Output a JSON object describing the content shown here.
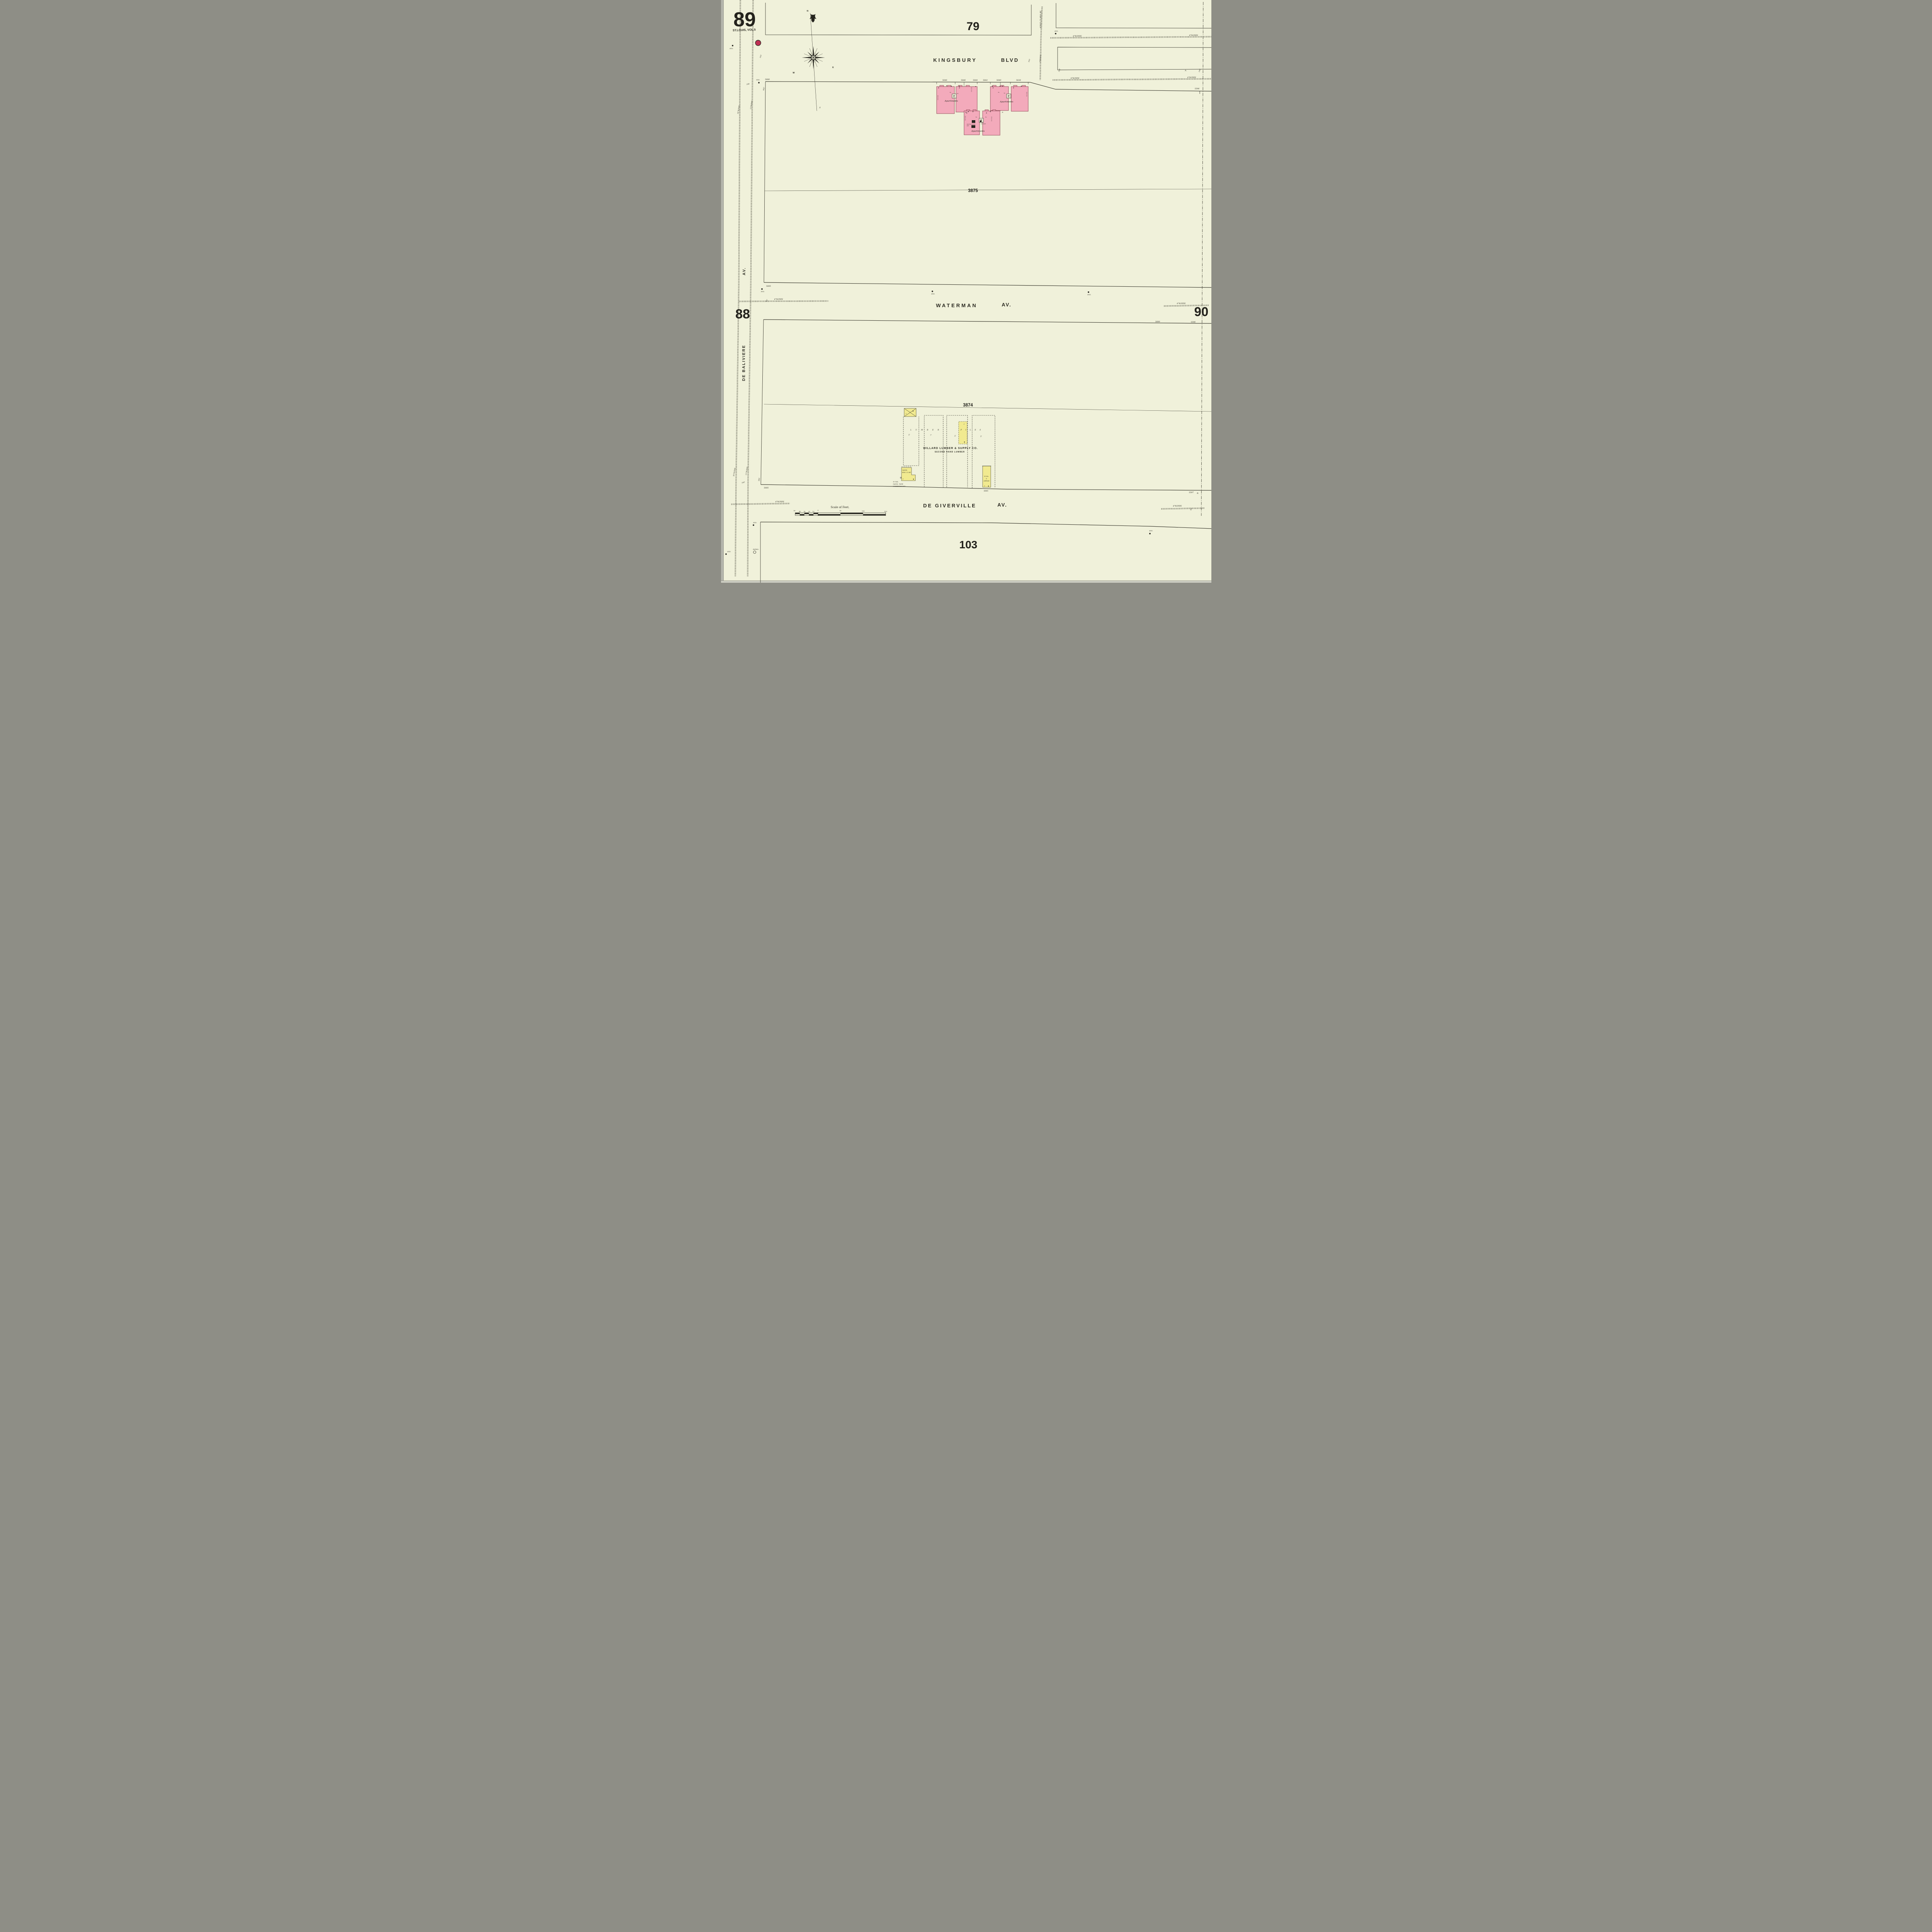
{
  "sheet": {
    "number": "89",
    "volume": "ST.LOUIS, VOL.5",
    "adjacent": {
      "top": "79",
      "left": "88",
      "right": "90",
      "bottom": "103"
    }
  },
  "compass": {
    "n": "N",
    "e": "E",
    "w": "W",
    "s": "S"
  },
  "streets": {
    "kingsbury": "KINGSBURY",
    "kingsbury_type": "BLVD",
    "waterman": "WATERMAN",
    "waterman_type": "AV.",
    "de_giverville": "DE GIVERVILLE",
    "de_giverville_type": "AV.",
    "de_baliviere": "DE BALIVIERE",
    "de_baliviere_type": "AV.",
    "clara_pipe": "6\"W.P. CLARA AV."
  },
  "blocks": {
    "north": "3875",
    "south": "3874"
  },
  "addresses": {
    "a5680": "5680",
    "a5648": "5648",
    "a5646": "5646",
    "a5644": "5644",
    "a5642": "5642",
    "a5640": "5640",
    "a5638": "5638",
    "a5596_ne": "5596",
    "a5685_waterman": "5685",
    "a5600": "5600",
    "a5596_waterman": "5596",
    "a5685_giverville": "5685",
    "a5641": "5641",
    "a5597": "5597",
    "letter_a": "A.",
    "letter_b": "B."
  },
  "apartments": {
    "label": "Apartments",
    "stories": "4",
    "elevator": "E",
    "ea": "Ea.",
    "b_mark": "B.",
    "heating1": "HEATING BLRS",
    "heating2": "BST-",
    "chimney": "CH.",
    "chimney_note": "10'ABV.RF.",
    "wall": [
      "16",
      "12",
      "12",
      "12"
    ]
  },
  "lumber": {
    "company": "WILLARD LUMBER & SUPPLY CO.",
    "company2": "SECOND HAND LUMBER",
    "word1": "LUMBER",
    "word2": "PILES",
    "dim1": "5'",
    "dim2": "7'",
    "dim3": "5'",
    "dim4": "5'",
    "one": "1",
    "gasol1": "GASOL",
    "gasol2": "ENG. 12 HP",
    "tank1": "50 GAL.",
    "tank2": "GASOL. TANK",
    "tank3": "UNDERGROUND.",
    "office1": "W. Ho.",
    "office2": "&",
    "office3": "OFFICE"
  },
  "pipes": {
    "p6": "6\"W.PIPE",
    "p4": "4\"W.PIPE",
    "p36": "36\"W.PIPE",
    "p12": "12\"W.PIPE"
  },
  "symbols": {
    "hyd": "HYD.",
    "patrol": "PATROL"
  },
  "dims": {
    "d100": "100'",
    "d100b": "100",
    "d442": "442'",
    "d136": "136'",
    "d196": "196'",
    "d300": "300'",
    "d80": "80'"
  },
  "scale": {
    "title": "Scale of Feet.",
    "labels": [
      "50",
      "40",
      "30",
      "20",
      "10",
      "0",
      "50",
      "100",
      "150"
    ]
  }
}
